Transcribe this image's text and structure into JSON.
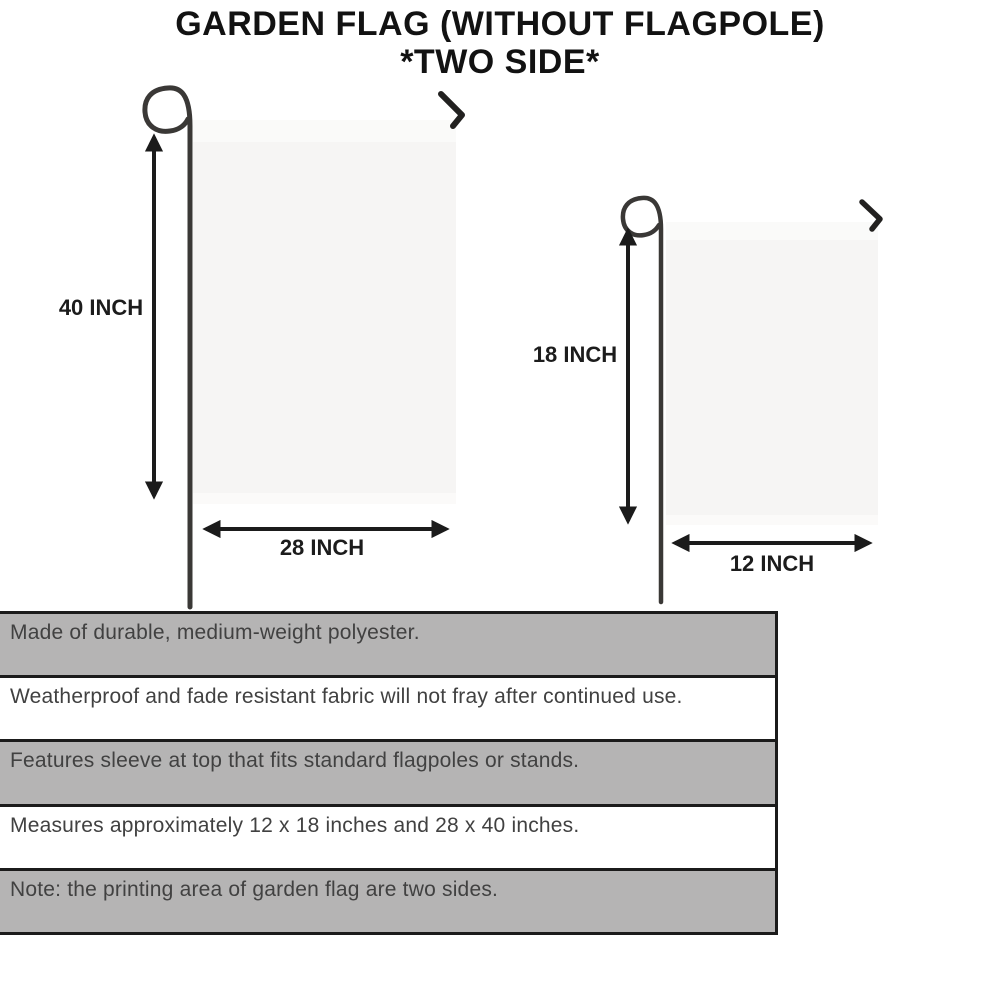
{
  "title": {
    "line1": "GARDEN FLAG (WITHOUT FLAGPOLE)",
    "line2": "*TWO SIDE*"
  },
  "diagrams": {
    "large_flag": {
      "height_label": "40 INCH",
      "width_label": "28 INCH"
    },
    "small_flag": {
      "height_label": "18 INCH",
      "width_label": "12 INCH"
    }
  },
  "features": [
    {
      "text": "Made of durable, medium-weight polyester.",
      "shaded": true
    },
    {
      "text": "Weatherproof and fade resistant fabric will not fray after continued use.",
      "shaded": false
    },
    {
      "text": "Features sleeve at top that fits standard flagpoles or stands.",
      "shaded": true
    },
    {
      "text": "Measures approximately 12 x 18 inches and 28 x 40 inches.",
      "shaded": false
    },
    {
      "text": "Note: the printing area of garden flag are two sides.",
      "shaded": true
    }
  ],
  "colors": {
    "ink": "#1b1b1b",
    "row_gray": "#b5b4b4",
    "row_text": "#414141",
    "flag_fill": "#f6f5f4",
    "flag_sleeve": "#fafaf9",
    "pole": "#3a3836"
  }
}
